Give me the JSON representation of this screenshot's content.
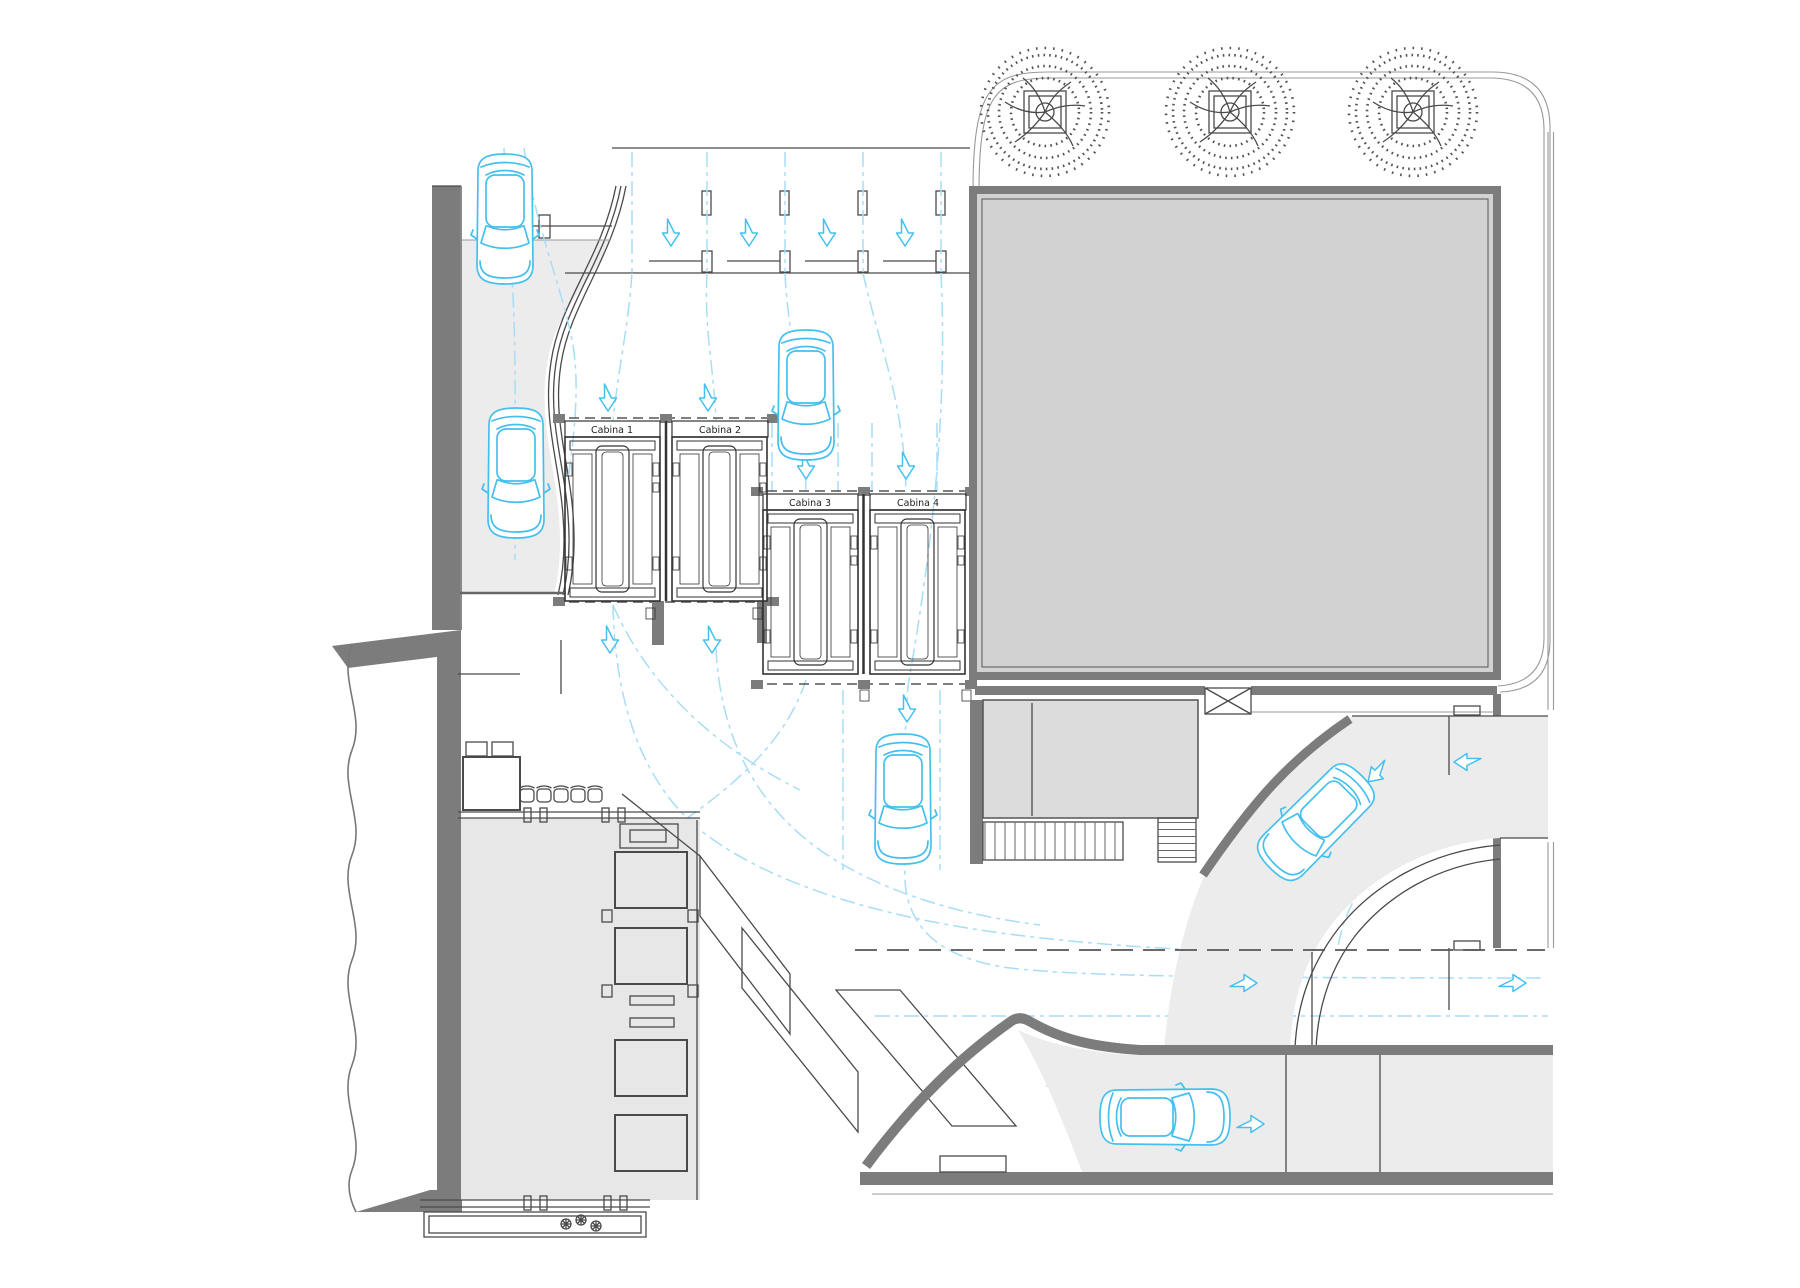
{
  "cabins": [
    {
      "label": "Cabina 1"
    },
    {
      "label": "Cabina 2"
    },
    {
      "label": "Cabina 3"
    },
    {
      "label": "Cabina 4"
    }
  ],
  "colors": {
    "cabin_yellow": "#FFD400",
    "cabin_yellow_deep": "#F2C400",
    "car_blue": "#45C0EE",
    "path_blue": "#A9DDF6",
    "wall_gray": "#7C7C7C",
    "building_gray": "#D2D2D2",
    "room_gray": "#DCDCDC",
    "surface_gray": "#ECECEC",
    "floor_gray": "#E7E7E7",
    "line_dark": "#4A4A4A"
  },
  "icons": {
    "car": "car-icon",
    "tree": "tree-icon",
    "chair": "chair-icon",
    "flower": "flower-icon",
    "flow_arrow": "flow-arrow-icon"
  },
  "counts": {
    "elevator_cabins": 4,
    "cars": 6,
    "trees": 3,
    "chairs": 5,
    "arrows_down": 11,
    "arrows_right": 3,
    "arrows_left": 1,
    "arrows_diagonal": 1
  }
}
